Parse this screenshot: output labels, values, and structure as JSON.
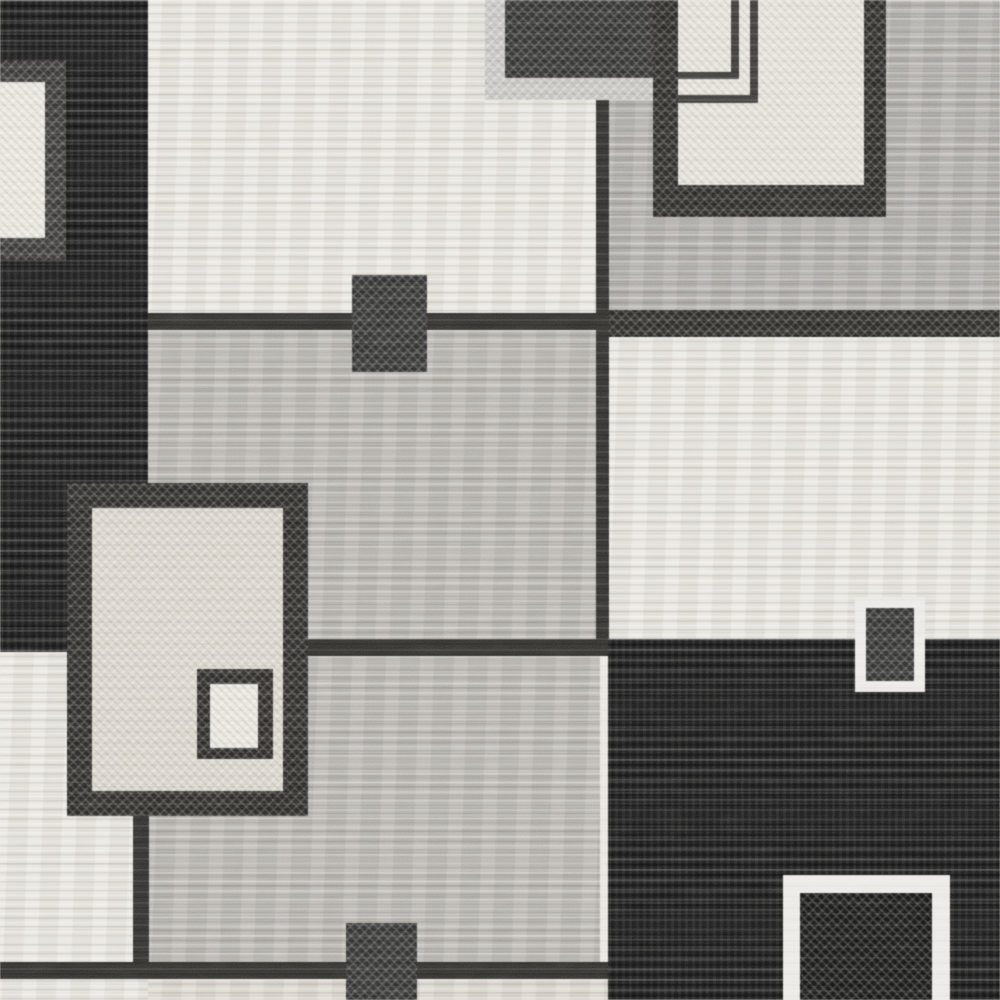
{
  "subject": "close-up photo of a black, gray and off-white geometric patchwork area rug with overlapping squares and rectangles",
  "canvas": {
    "width": 1000,
    "height": 1000
  },
  "palette": {
    "black": "#1c1c1c",
    "charcoal": "#33312e",
    "frame": "#444240",
    "darksq": "#3b3b3b",
    "outline": "#3f3d3a",
    "gray": "#b1aea9",
    "gray2": "#b8b5af",
    "cream": "#e9e6df",
    "cream2": "#e4e1d9",
    "creamdim": "#dbd7cf",
    "oatmeal": "#d9d5cc",
    "lightbar": "#c9c7c2",
    "white": "#eae9e5"
  },
  "regions": [
    {
      "name": "field-black-top-left",
      "x": 0,
      "y": 0,
      "w": 150,
      "h": 652,
      "fill": "black",
      "tex": "streakDark"
    },
    {
      "name": "field-cream-top-middle",
      "x": 148,
      "y": 0,
      "w": 452,
      "h": 318,
      "fill": "cream",
      "tex": "streakLight"
    },
    {
      "name": "field-gray-top-right",
      "x": 605,
      "y": 0,
      "w": 395,
      "h": 312,
      "fill": "gray",
      "tex": "streakLight"
    },
    {
      "name": "divider-top-right",
      "x": 605,
      "y": 310,
      "w": 395,
      "h": 27,
      "fill": "charcoal",
      "tex": "speckleDark"
    },
    {
      "name": "field-cream-right",
      "x": 605,
      "y": 337,
      "w": 395,
      "h": 303,
      "fill": "cream",
      "tex": "streakLight"
    },
    {
      "name": "line-under-cream-top",
      "x": 148,
      "y": 313,
      "w": 460,
      "h": 17,
      "fill": "charcoal",
      "tex": "flat"
    },
    {
      "name": "field-gray-center",
      "x": 148,
      "y": 330,
      "w": 452,
      "h": 309,
      "fill": "gray2",
      "tex": "streakLight"
    },
    {
      "name": "field-black-bottom-right",
      "x": 608,
      "y": 639,
      "w": 392,
      "h": 361,
      "fill": "black",
      "tex": "streakDark"
    },
    {
      "name": "line-center-right",
      "x": 305,
      "y": 639,
      "w": 303,
      "h": 17,
      "fill": "charcoal",
      "tex": "flat"
    },
    {
      "name": "field-gray-center-bottom",
      "x": 148,
      "y": 656,
      "w": 452,
      "h": 307,
      "fill": "gray2",
      "tex": "streakLight"
    },
    {
      "name": "field-cream-bottom-left",
      "x": 0,
      "y": 652,
      "w": 148,
      "h": 348,
      "fill": "cream",
      "tex": "streakLight"
    },
    {
      "name": "line-bottom",
      "x": 0,
      "y": 962,
      "w": 608,
      "h": 17,
      "fill": "charcoal",
      "tex": "flat"
    },
    {
      "name": "strip-bottom-cream",
      "x": 148,
      "y": 979,
      "w": 460,
      "h": 21,
      "fill": "creamdim",
      "tex": "streakLight"
    },
    {
      "name": "line-vertical-left",
      "x": 133,
      "y": 816,
      "w": 16,
      "h": 148,
      "fill": "charcoal",
      "tex": "flat"
    },
    {
      "name": "line-vertical-center",
      "x": 596,
      "y": 98,
      "w": 13,
      "h": 541,
      "fill": "charcoal",
      "tex": "flat"
    },
    {
      "name": "square-top-left-frame",
      "x": 0,
      "y": 60,
      "w": 66,
      "h": 200,
      "fill": "frame",
      "tex": "speckleDark"
    },
    {
      "name": "square-top-left-inner",
      "x": 0,
      "y": 82,
      "w": 45,
      "h": 156,
      "fill": "cream",
      "tex": "speckleLight"
    },
    {
      "name": "bar-top-light",
      "x": 485,
      "y": 0,
      "w": 168,
      "h": 100,
      "fill": "lightbar",
      "tex": "speckleLight"
    },
    {
      "name": "square-top-dark",
      "x": 505,
      "y": 0,
      "w": 148,
      "h": 78,
      "fill": "darksq",
      "tex": "speckleDark"
    },
    {
      "name": "panel-top-right-frame",
      "x": 653,
      "y": 0,
      "w": 233,
      "h": 217,
      "fill": "charcoal",
      "tex": "speckleDark"
    },
    {
      "name": "panel-top-right-inner",
      "x": 678,
      "y": 0,
      "w": 186,
      "h": 185,
      "fill": "cream2",
      "tex": "speckleLight"
    },
    {
      "name": "panel-outline-h1",
      "x": 678,
      "y": 72,
      "w": 60,
      "h": 7,
      "fill": "outline",
      "tex": "flat"
    },
    {
      "name": "panel-outline-v1",
      "x": 731,
      "y": 0,
      "w": 8,
      "h": 79,
      "fill": "outline",
      "tex": "flat"
    },
    {
      "name": "panel-outline-h2",
      "x": 678,
      "y": 95,
      "w": 80,
      "h": 8,
      "fill": "outline",
      "tex": "flat"
    },
    {
      "name": "panel-outline-v2",
      "x": 750,
      "y": 0,
      "w": 8,
      "h": 103,
      "fill": "outline",
      "tex": "flat"
    },
    {
      "name": "rect-center-dark",
      "x": 352,
      "y": 275,
      "w": 75,
      "h": 97,
      "fill": "darksq",
      "tex": "speckleDark"
    },
    {
      "name": "bigrect-frame",
      "x": 67,
      "y": 483,
      "w": 241,
      "h": 333,
      "fill": "charcoal",
      "tex": "speckleDark"
    },
    {
      "name": "bigrect-inner",
      "x": 92,
      "y": 508,
      "w": 191,
      "h": 283,
      "fill": "oatmeal",
      "tex": "speckleLight"
    },
    {
      "name": "bigrect-small-frame",
      "x": 197,
      "y": 669,
      "w": 76,
      "h": 90,
      "fill": "charcoal",
      "tex": "speckleDark"
    },
    {
      "name": "bigrect-small-inner",
      "x": 210,
      "y": 684,
      "w": 48,
      "h": 64,
      "fill": "cream",
      "tex": "speckleLight"
    },
    {
      "name": "rect-bottom-center-dark",
      "x": 346,
      "y": 923,
      "w": 71,
      "h": 77,
      "fill": "darksq",
      "tex": "speckleDark"
    },
    {
      "name": "wframe-small",
      "x": 855,
      "y": 597,
      "w": 70,
      "h": 95,
      "fill": "white",
      "tex": "flat"
    },
    {
      "name": "wframe-small-inner",
      "x": 866,
      "y": 608,
      "w": 48,
      "h": 73,
      "fill": "darksq",
      "tex": "speckleDark"
    },
    {
      "name": "wframe-big",
      "x": 783,
      "y": 875,
      "w": 167,
      "h": 125,
      "fill": "white",
      "tex": "flat"
    },
    {
      "name": "wframe-big-inner",
      "x": 800,
      "y": 893,
      "w": 132,
      "h": 107,
      "fill": "black",
      "tex": "speckleDark"
    }
  ]
}
